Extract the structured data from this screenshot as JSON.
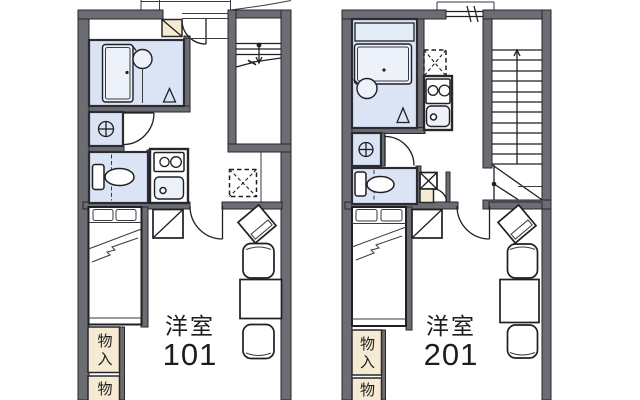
{
  "floorplan": {
    "units": [
      {
        "room_label": "洋室",
        "room_number": "101",
        "storage_top_label": "物入",
        "storage_bottom_label": "物"
      },
      {
        "room_label": "洋室",
        "room_number": "201",
        "storage_top_label": "物入",
        "storage_bottom_label": "物"
      }
    ],
    "fixture_icons": [
      "bathtub-icon",
      "washbasin-icon",
      "toilet-icon",
      "washing-machine-icon",
      "gas-stove-icon",
      "kitchen-sink-icon",
      "refrigerator-space-icon",
      "bed-icon",
      "closet-icon",
      "tv-stand-icon",
      "dining-table-icon",
      "chair-icon",
      "staircase-icon",
      "entrance-door-icon",
      "shoe-cabinet-icon",
      "storage-icon"
    ],
    "colors": {
      "wall": "#6c6c73",
      "wet_room_blue": "#dbe4f4",
      "fixture_blue": "#ecf1fa",
      "storage_beige": "#f5ead2",
      "line": "#1f1f24",
      "text": "#1d1d1f",
      "background": "#ffffff"
    }
  }
}
